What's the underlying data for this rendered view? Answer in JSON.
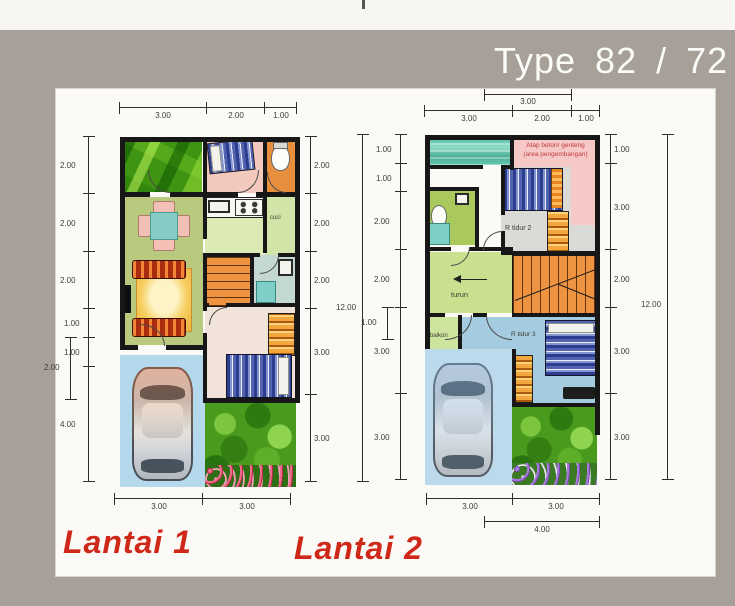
{
  "title": "Type 82 / 72",
  "floor1": {
    "label": "Lantai 1",
    "rooms": {
      "cuci": "cuci"
    },
    "dims": {
      "top": [
        "3.00",
        "2.00",
        "1.00"
      ],
      "left": [
        "2.00",
        "2.00",
        "2.00",
        "1.00",
        "1.00",
        "4.00"
      ],
      "left_offset": "2.00",
      "right": [
        "2.00",
        "2.00",
        "2.00",
        "3.00",
        "3.00"
      ],
      "bottom": [
        "3.00",
        "3.00"
      ],
      "total": "12.00"
    }
  },
  "floor2": {
    "label": "Lantai 2",
    "rooms": {
      "atap1": "Atap beton/ genteng",
      "atap2": "(area pengembangan)",
      "bedroom2": "R tidur 2",
      "stairs_down": "turun",
      "balcony": "balkon",
      "bedroom3": "R tidur 3"
    },
    "dims": {
      "top_offset": "3.00",
      "top": [
        "3.00",
        "2.00",
        "1.00"
      ],
      "left": [
        "1.00",
        "1.00",
        "2.00",
        "2.00",
        "3.00",
        "3.00"
      ],
      "left_offset": "1.00",
      "right": [
        "1.00",
        "3.00",
        "2.00",
        "3.00",
        "3.00"
      ],
      "bottom": [
        "3.00",
        "3.00"
      ],
      "bottom_offset": "4.00",
      "total": "12.00"
    }
  }
}
